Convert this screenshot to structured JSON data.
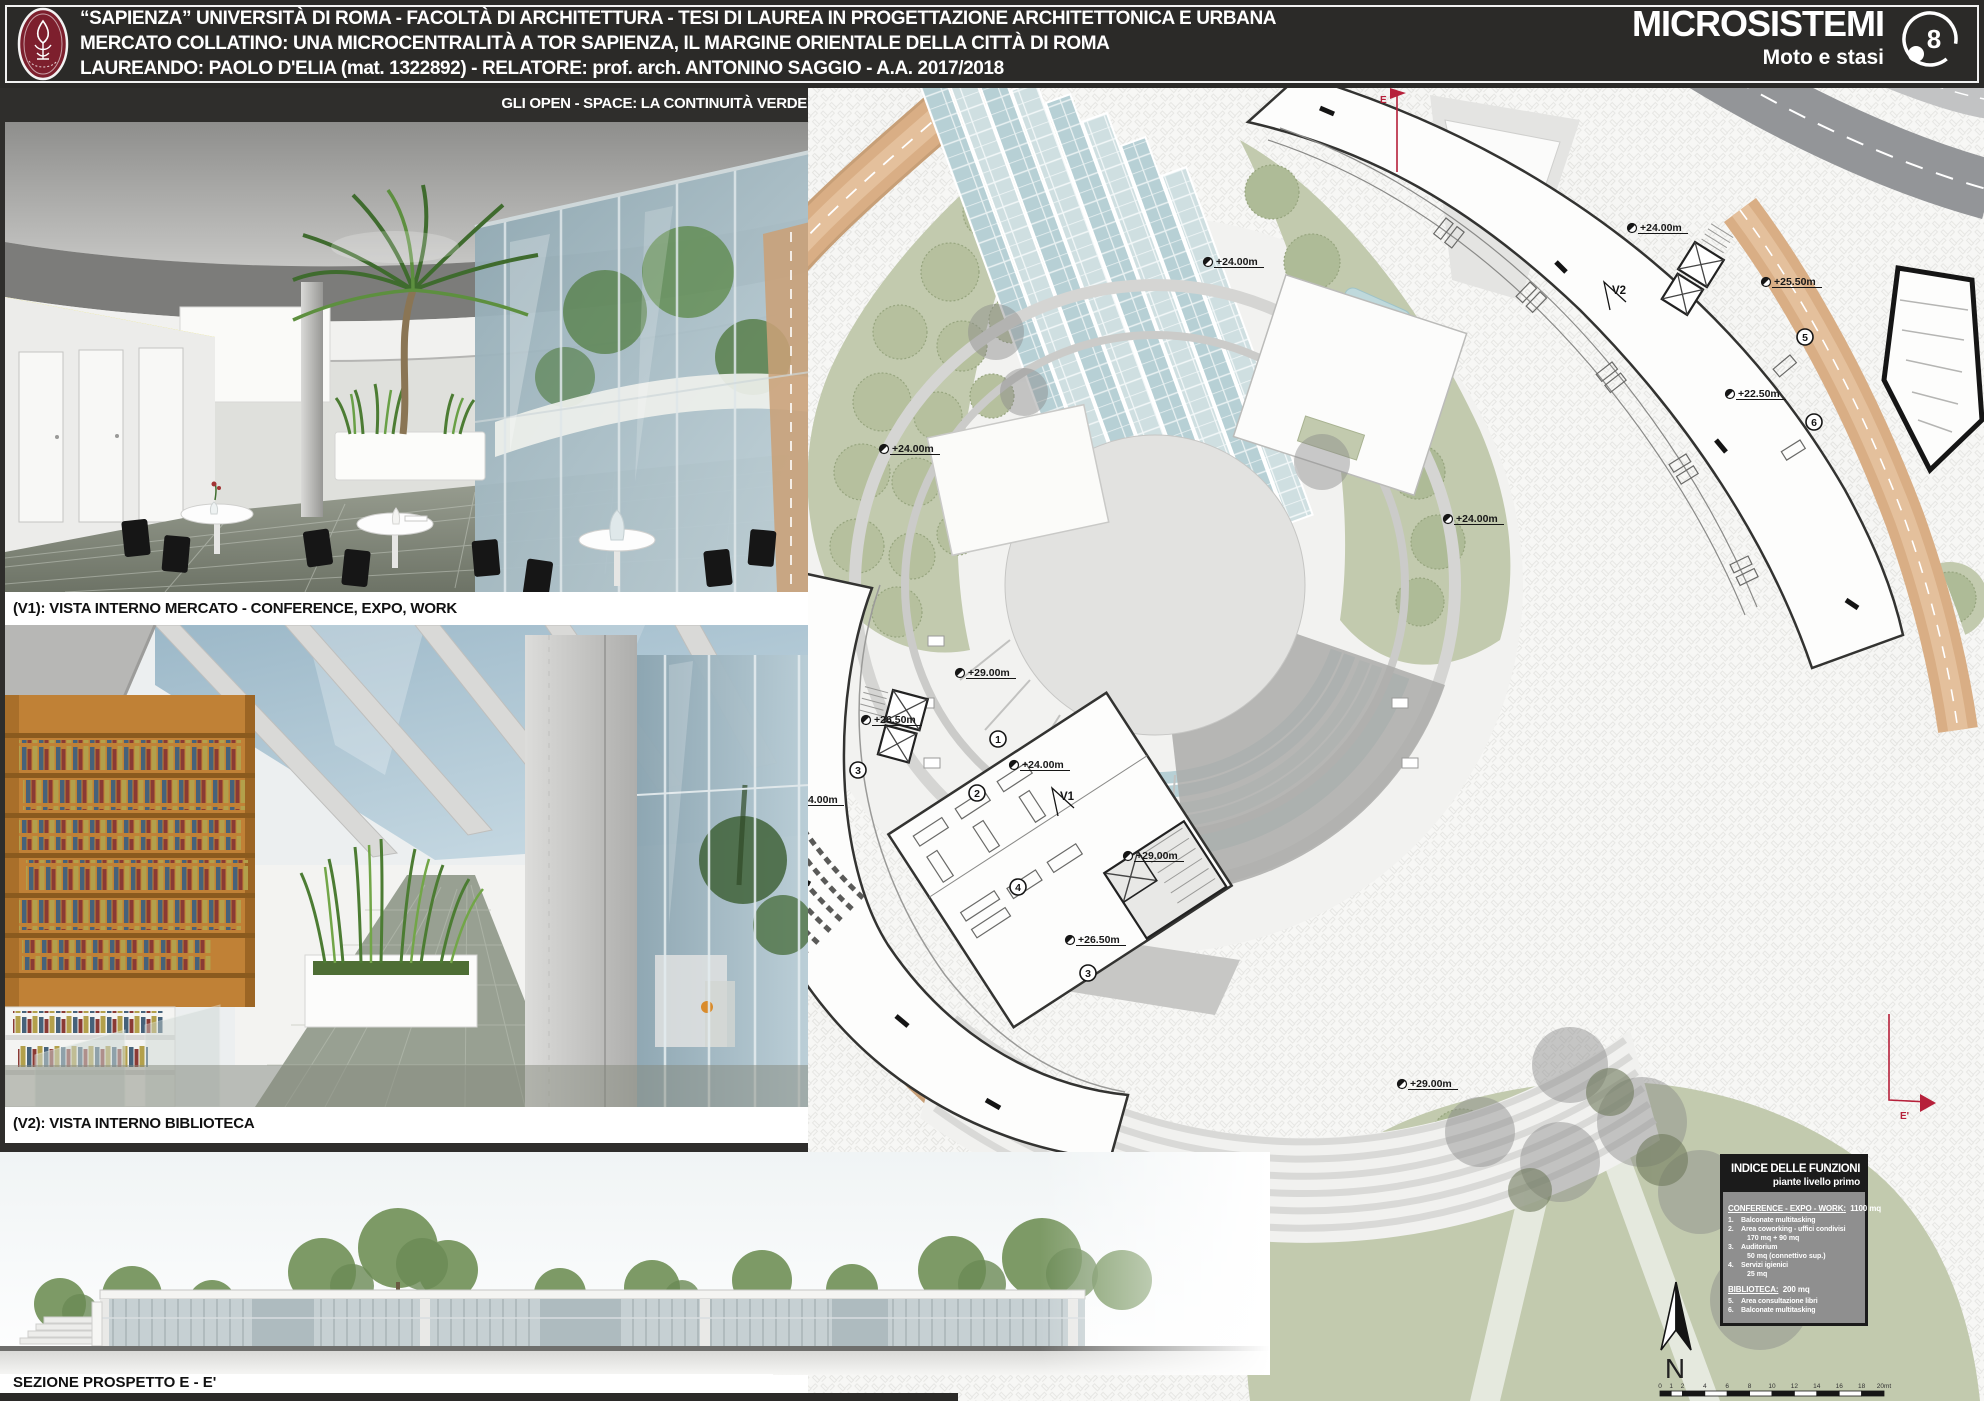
{
  "header": {
    "line1": "“SAPIENZA” UNIVERSITÀ DI ROMA  -  FACOLTÀ DI ARCHITETTURA - TESI DI LAUREA IN PROGETTAZIONE ARCHITETTONICA E URBANA",
    "line2": "MERCATO COLLATINO:  UNA MICROCENTRALITÀ A TOR SAPIENZA, IL MARGINE ORIENTALE DELLA CITTÀ DI ROMA",
    "line3": "LAUREANDO: PAOLO D'ELIA (mat. 1322892)  -  RELATORE: prof. arch. ANTONINO SAGGIO  -  A.A. 2017/2018",
    "series_title": "MICROSISTEMI",
    "series_subtitle": "Moto e stasi",
    "sheet_number": "8"
  },
  "left_column": {
    "strip_caption": "GLI OPEN - SPACE: LA CONTINUITÀ VERDE",
    "v1_caption": "(V1): VISTA INTERNO MERCATO - CONFERENCE, EXPO, WORK",
    "v2_caption": "(V2): VISTA INTERNO BIBLIOTECA"
  },
  "section": {
    "caption": "SEZIONE PROSPETTO E - E'"
  },
  "plan": {
    "elevation_labels": [
      {
        "text": "+24.00m",
        "x": 884,
        "y": 449
      },
      {
        "text": "+24.00m",
        "x": 1208,
        "y": 262
      },
      {
        "text": "+24.00m",
        "x": 1632,
        "y": 228
      },
      {
        "text": "+25.50m",
        "x": 1766,
        "y": 282
      },
      {
        "text": "+22.50m",
        "x": 1730,
        "y": 394
      },
      {
        "text": "+24.00m",
        "x": 1448,
        "y": 519
      },
      {
        "text": "+29.00m",
        "x": 960,
        "y": 673
      },
      {
        "text": "+26.50m",
        "x": 866,
        "y": 720
      },
      {
        "text": "+24.00m",
        "x": 788,
        "y": 800
      },
      {
        "text": "+29.00m",
        "x": 726,
        "y": 839
      },
      {
        "text": "+24.00m",
        "x": 1014,
        "y": 765
      },
      {
        "text": "+29.00m",
        "x": 1128,
        "y": 856
      },
      {
        "text": "+26.50m",
        "x": 1070,
        "y": 940
      },
      {
        "text": "+29.00m",
        "x": 1402,
        "y": 1084
      }
    ],
    "function_markers": [
      {
        "n": "7",
        "x": 797,
        "y": 584
      },
      {
        "n": "2",
        "x": 775,
        "y": 629
      },
      {
        "n": "3",
        "x": 858,
        "y": 770
      },
      {
        "n": "1",
        "x": 998,
        "y": 739
      },
      {
        "n": "2",
        "x": 977,
        "y": 793
      },
      {
        "n": "4",
        "x": 1018,
        "y": 887
      },
      {
        "n": "3",
        "x": 1088,
        "y": 973
      },
      {
        "n": "5",
        "x": 1805,
        "y": 337
      },
      {
        "n": "6",
        "x": 1814,
        "y": 422
      }
    ],
    "view_markers": [
      {
        "label": "V1",
        "x": 1072,
        "y": 796
      },
      {
        "label": "V2",
        "x": 1624,
        "y": 290
      }
    ],
    "section_cut_labels": [
      {
        "label": "E",
        "x": 1380,
        "y": 103
      },
      {
        "label": "E'",
        "x": 1900,
        "y": 1119
      }
    ],
    "north_label": "N",
    "scale": {
      "x": 1660,
      "y": 1391,
      "unit_px": 11.2,
      "ticks": [
        0,
        1,
        2,
        4,
        6,
        8,
        10,
        12,
        14,
        16,
        18
      ],
      "last_label": "20mt"
    }
  },
  "legend": {
    "title": "INDICE DELLE FUNZIONI",
    "subtitle": "piante livello primo",
    "groups": [
      {
        "heading": "CONFERENCE - EXPO - WORK:",
        "area": "1100 mq",
        "items": [
          {
            "n": "1.",
            "label": "Balconate multitasking",
            "detail": ""
          },
          {
            "n": "2.",
            "label": "Area coworking - uffici condivisi",
            "detail": "170 mq + 90 mq"
          },
          {
            "n": "3.",
            "label": "Auditorium",
            "detail": "50 mq (connettivo sup.)"
          },
          {
            "n": "4.",
            "label": "Servizi igienici",
            "detail": "25 mq"
          }
        ]
      },
      {
        "heading": "BIBLIOTECA:",
        "area": "200 mq",
        "items": [
          {
            "n": "5.",
            "label": "Area consultazione libri",
            "detail": ""
          },
          {
            "n": "6.",
            "label": "Balconate multitasking",
            "detail": ""
          }
        ]
      }
    ]
  },
  "colors": {
    "header_black": "#2b2a28",
    "logo_maroon": "#7d1f2d",
    "accent_red": "#b6203a",
    "road_tan": "#d8ae85",
    "park_green": "#c2caae",
    "glass_blue": "#b7d0d5",
    "legend_gray": "#8f8f8f"
  }
}
